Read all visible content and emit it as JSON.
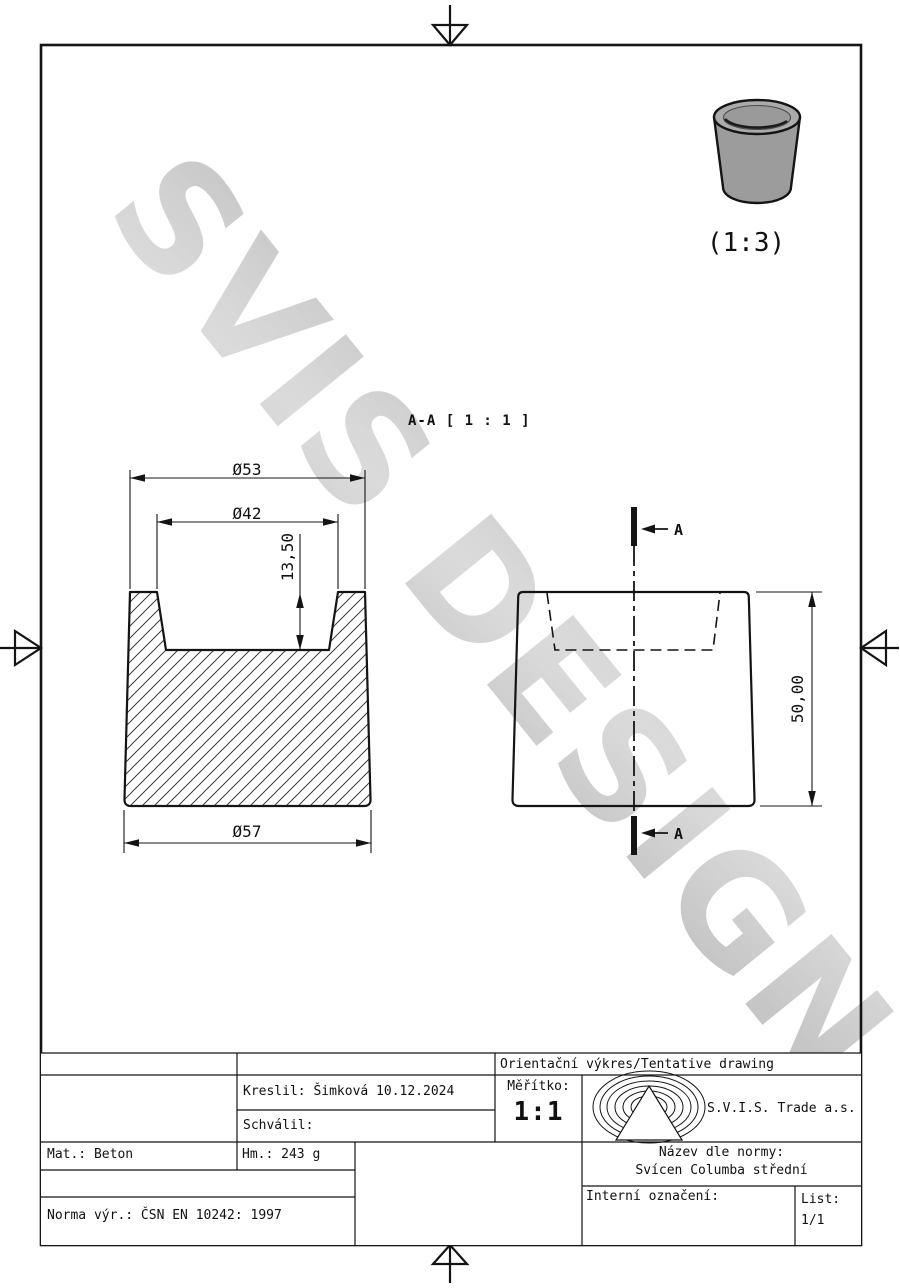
{
  "watermark": {
    "text": "SVIS DESIGN",
    "color": "#c6c6c6"
  },
  "iso_view": {
    "scale_label": "(1:3)",
    "body_color": "#9c9c9c"
  },
  "section_view": {
    "label": "A-A [ 1 : 1 ]",
    "dim_top_outer_diameter": "Ø53",
    "dim_top_inner_diameter": "Ø42",
    "dim_cavity_depth": "13,50",
    "dim_bottom_diameter": "Ø57"
  },
  "front_view": {
    "cut_marker_top": "A",
    "cut_marker_bottom": "A",
    "dim_height": "50,00"
  },
  "title_block": {
    "drawing_type": "Orientační výkres/Tentative drawing",
    "drawn_by": "Kreslil: Šimková 10.12.2024",
    "approved_by": "Schválil:",
    "scale_label": "Měřítko:",
    "scale_value": "1:1",
    "company": "S.V.I.S. Trade a.s.",
    "material": "Mat.: Beton",
    "weight": "Hm.: 243 g",
    "standard": "Norma výr.: ČSN EN 10242: 1997",
    "name_label": "Název dle normy:",
    "name_value": "Svícen Columba střední",
    "internal_label": "Interní označení:",
    "sheet_label": "List:",
    "sheet_value": "1/1"
  },
  "colors": {
    "line": "#141414",
    "hatch": "#3c3c3c"
  }
}
